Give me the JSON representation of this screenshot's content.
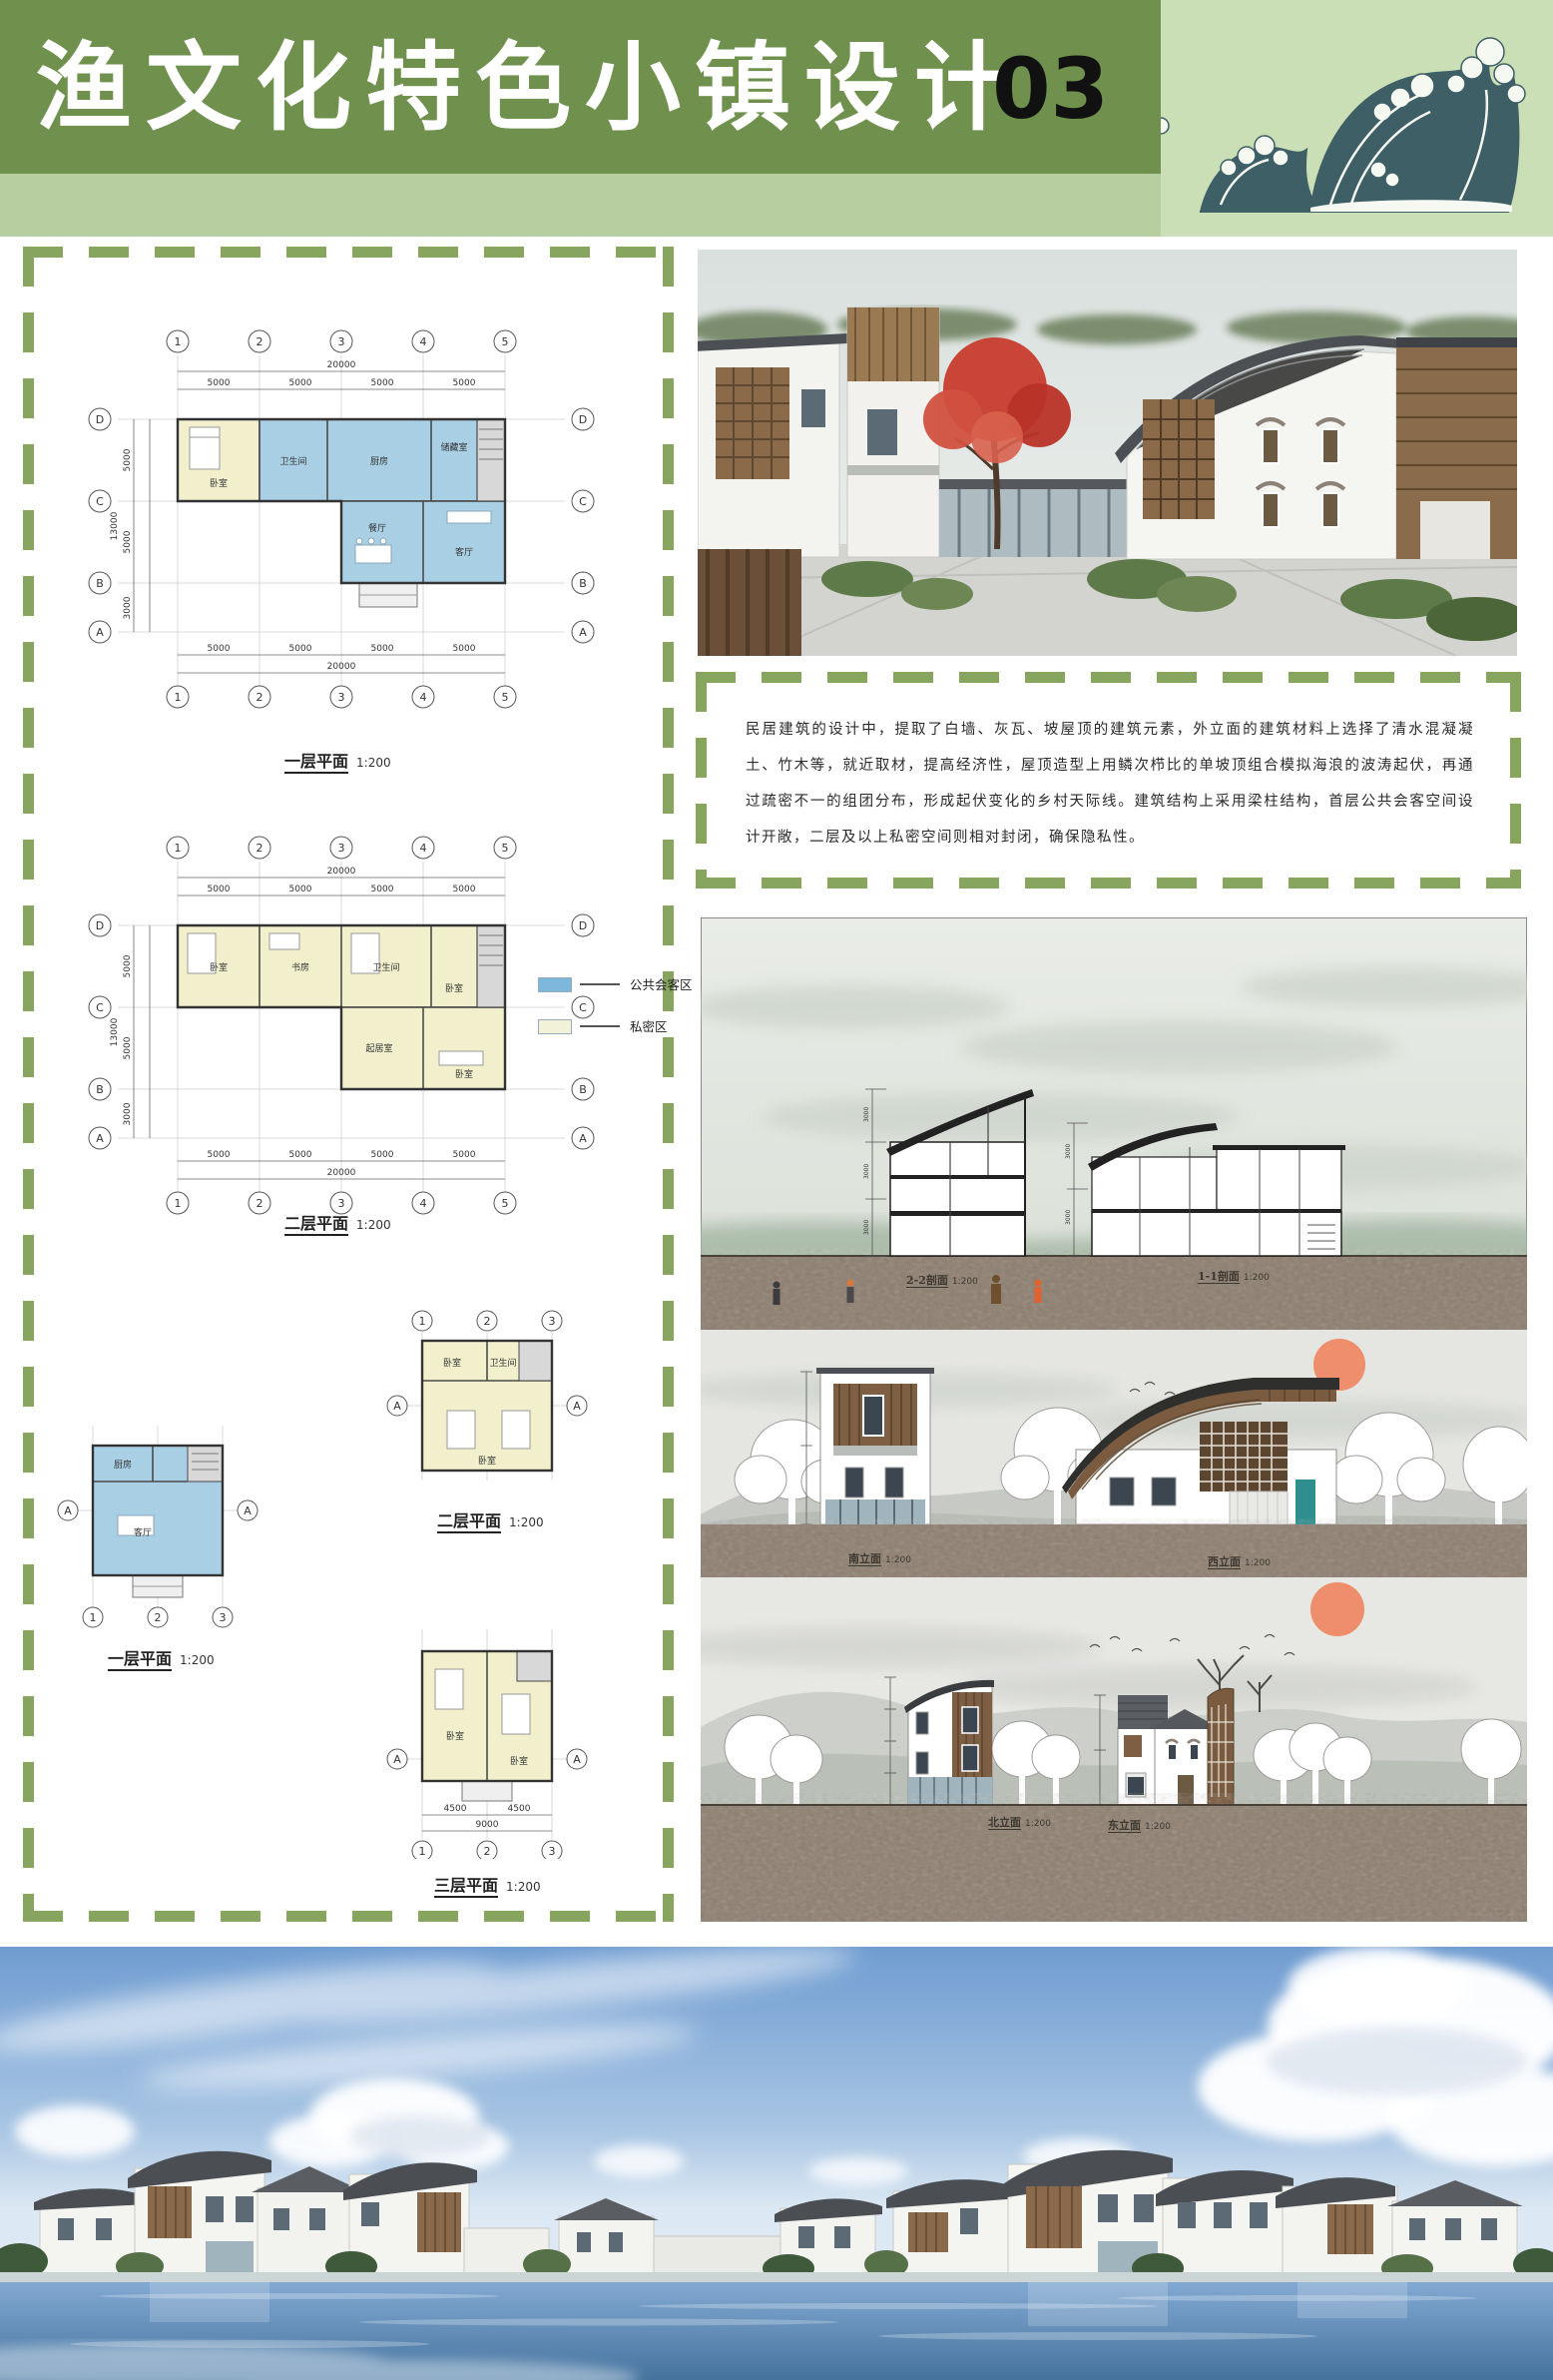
{
  "header": {
    "title": "渔文化特色小镇设计",
    "page_number": "03"
  },
  "palette": {
    "header_green": "#70904E",
    "header_light_green": "#B7CFA0",
    "wave_background": "#CBDFB7",
    "wave_ink": "#3E5F66",
    "dash_green": "#87A55E",
    "public_zone_blue": "#7DB8DC",
    "private_zone_cream": "#F2F2D9"
  },
  "left_panel": {
    "legend": {
      "items": [
        {
          "label": "公共会客区",
          "color": "#7DB8DC"
        },
        {
          "label": "私密区",
          "color": "#F2F2D9"
        }
      ]
    },
    "plans": [
      {
        "caption": "一层平面",
        "scale": "1:200",
        "axes_top": [
          "1",
          "2",
          "3",
          "4",
          "5"
        ],
        "axes_side": [
          "D",
          "C",
          "B",
          "A"
        ],
        "dim_total_top": "20000",
        "dims_top": [
          "5000",
          "5000",
          "5000",
          "5000"
        ],
        "dim_total_side": "13000",
        "dims_side": [
          "5000",
          "5000",
          "3000"
        ],
        "rooms": [
          "卧室",
          "卫生间",
          "厨房",
          "储藏室",
          "餐厅",
          "客厅"
        ]
      },
      {
        "caption": "二层平面",
        "scale": "1:200",
        "axes_top": [
          "1",
          "2",
          "3",
          "4",
          "5"
        ],
        "axes_side": [
          "D",
          "C",
          "B",
          "A"
        ],
        "dim_total_top": "20000",
        "dims_top": [
          "5000",
          "5000",
          "5000",
          "5000"
        ],
        "dim_total_side": "13000",
        "dims_side": [
          "5000",
          "5000",
          "3000"
        ],
        "rooms": [
          "卧室",
          "书房",
          "卫生间",
          "卧室",
          "起居室",
          "卧室"
        ]
      },
      {
        "caption": "一层平面",
        "scale": "1:200",
        "axes_top": [
          "1",
          "2",
          "3"
        ],
        "axes_side": [
          "A"
        ],
        "rooms": [
          "厨房",
          "客厅"
        ]
      },
      {
        "caption": "二层平面",
        "scale": "1:200",
        "axes_top": [
          "1",
          "2",
          "3"
        ],
        "axes_side": [
          "A"
        ],
        "rooms": [
          "卧室",
          "卫生间",
          "卧室"
        ]
      },
      {
        "caption": "三层平面",
        "scale": "1:200",
        "axes_top": [
          "1",
          "2",
          "3"
        ],
        "axes_side": [
          "A"
        ],
        "dims_top": [
          "4500",
          "4500"
        ],
        "dim_total_top": "9000",
        "rooms": [
          "卧室",
          "卧室"
        ]
      }
    ]
  },
  "right_panel": {
    "description": "民居建筑的设计中，提取了白墙、灰瓦、坡屋顶的建筑元素，外立面的建筑材料上选择了清水混凝凝土、竹木等，就近取材，提高经济性，屋顶造型上用鳞次栉比的单坡顶组合模拟海浪的波涛起伏，再通过疏密不一的组团分布，形成起伏变化的乡村天际线。建筑结构上采用梁柱结构，首层公共会客空间设计开敞，二层及以上私密空间则相对封闭，确保隐私性。",
    "section_drawing": {
      "captions": [
        {
          "label": "2-2剖面",
          "scale": "1:200"
        },
        {
          "label": "1-1剖面",
          "scale": "1:200"
        }
      ],
      "dim_label": "3000"
    },
    "south_west_elevations": {
      "captions": [
        {
          "label": "南立面",
          "scale": "1:200"
        },
        {
          "label": "西立面",
          "scale": "1:200"
        }
      ]
    },
    "north_east_elevations": {
      "captions": [
        {
          "label": "北立面",
          "scale": "1:200"
        },
        {
          "label": "东立面",
          "scale": "1:200"
        }
      ]
    }
  }
}
